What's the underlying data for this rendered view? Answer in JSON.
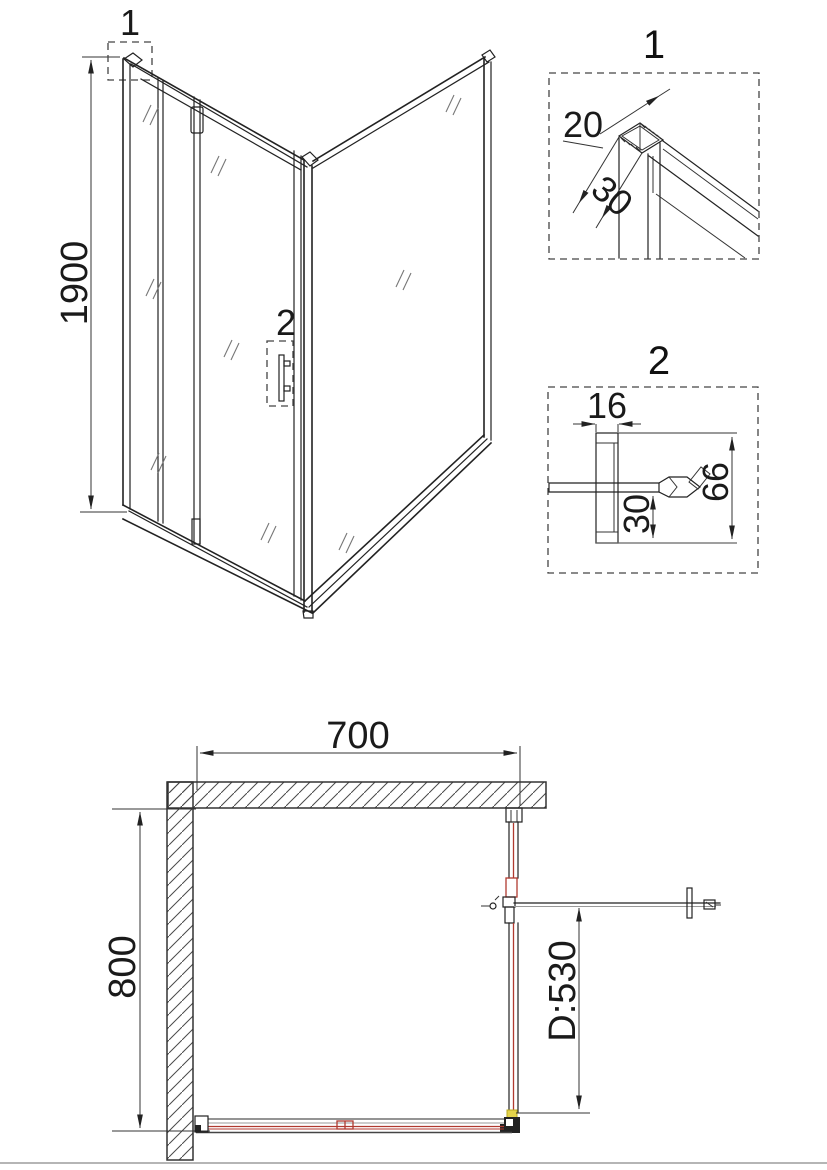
{
  "front_view": {
    "height_dim": "1900",
    "callout_1": "1",
    "callout_2": "2"
  },
  "detail_1": {
    "title": "1",
    "dim_20": "20",
    "dim_30": "30"
  },
  "detail_2": {
    "title": "2",
    "dim_16": "16",
    "dim_30": "30",
    "dim_66": "66"
  },
  "plan_view": {
    "width_dim": "700",
    "depth_dim": "800",
    "door_dim": "D:530"
  },
  "colors": {
    "line": "#222222",
    "thin": "#333333",
    "glass-tick": "#777777",
    "red": "#b03a30",
    "yellow": "#e4d34b",
    "hatch": "#4a4a4a",
    "page-line": "#b5b5b5",
    "bg": "#ffffff"
  }
}
